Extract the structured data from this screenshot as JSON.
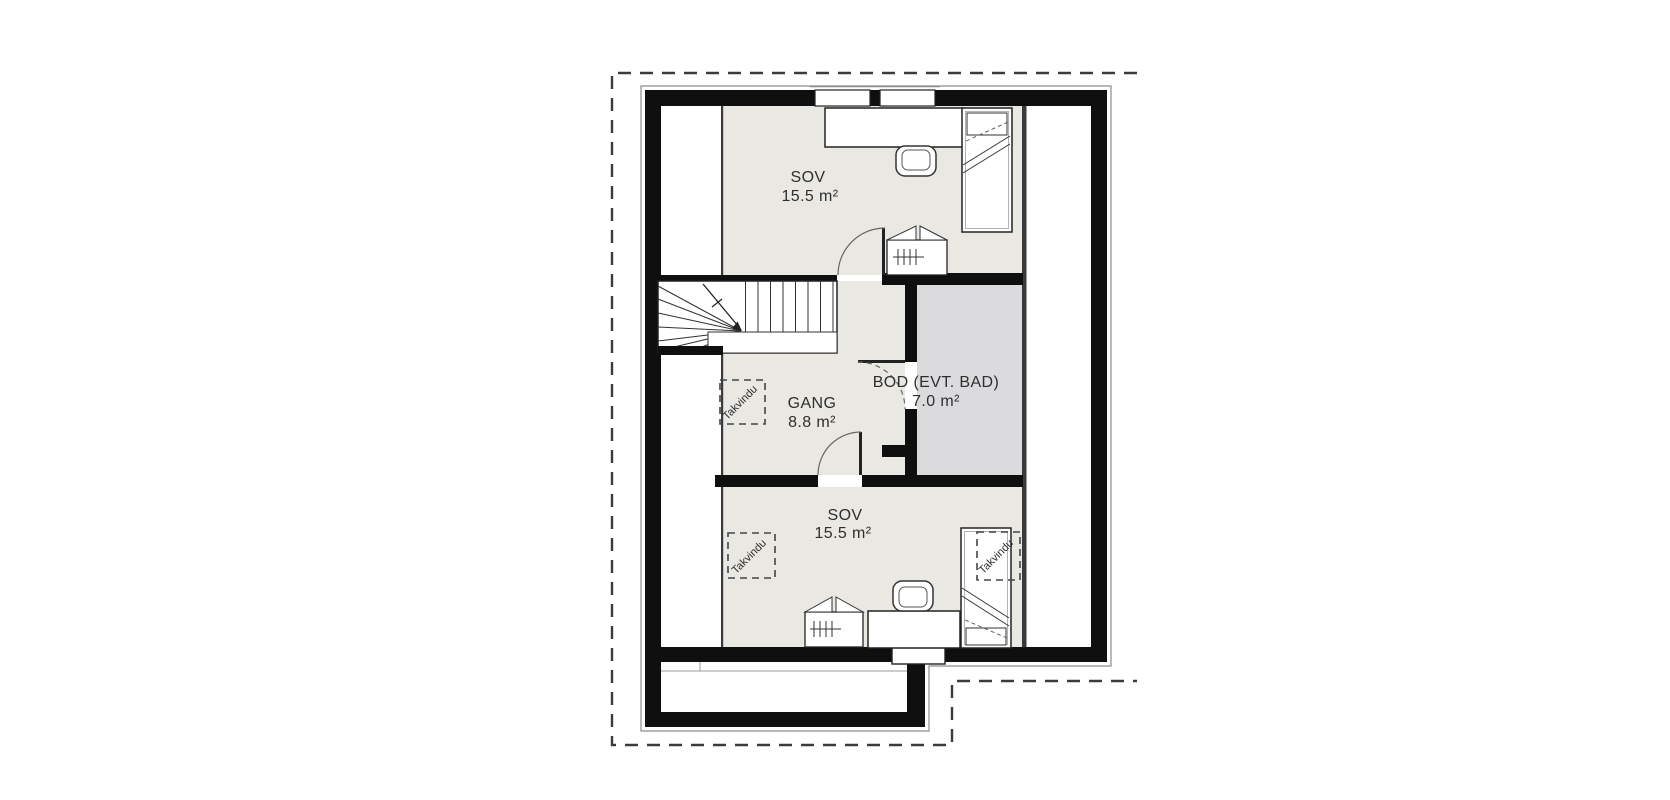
{
  "plan": {
    "rooms": [
      {
        "id": "sov-top",
        "name": "SOV",
        "area": "15.5 m²",
        "fill": "#e9e8e2"
      },
      {
        "id": "gang",
        "name": "GANG",
        "area": "8.8 m²",
        "fill": "#e9e8e2"
      },
      {
        "id": "bod",
        "name": "BOD (EVT. BAD)",
        "area": "7.0 m²",
        "fill": "#dbdbde"
      },
      {
        "id": "sov-bottom",
        "name": "SOV",
        "area": "15.5 m²",
        "fill": "#e9e8e2"
      }
    ],
    "skylights": [
      {
        "label": "Takvindu"
      },
      {
        "label": "Takvindu"
      },
      {
        "label": "Takvindu"
      }
    ],
    "colors": {
      "wall": "#0f0f0f",
      "room_beige": "#e9e8e2",
      "room_gray": "#dbdbde",
      "thin_line": "#3a3a3a",
      "trim": "#8d8d8d",
      "dash_outline": "#3c3c3c"
    }
  }
}
